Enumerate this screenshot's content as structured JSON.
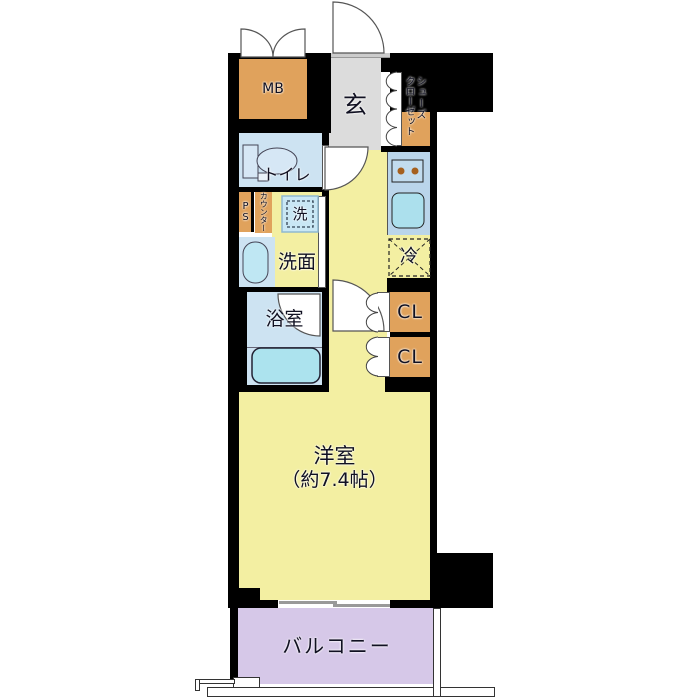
{
  "labels": {
    "mb": "MB",
    "entrance": "玄",
    "shoe_closet_line1": "シューズ",
    "shoe_closet_line2": "クローゼット",
    "toilet": "トイレ",
    "pipe_space": "PS",
    "counter": "カウンター",
    "washer": "洗",
    "washroom": "洗面",
    "fridge": "冷",
    "bathroom": "浴室",
    "closet_upper": "CL",
    "closet_lower": "CL",
    "main_room_name": "洋室",
    "main_room_size": "（約7.4帖）",
    "balcony": "バルコニー"
  },
  "colors": {
    "wall": "#000000",
    "floor_yellow": "#f3efa2",
    "entrance_gray": "#dcdcdc",
    "wet_area_blue": "#cde3f2",
    "fixture_cyan": "#aee3ef",
    "kitchen_counter_blue": "#bad5ea",
    "storage_orange": "#e0a25c",
    "balcony_purple": "#d6c8e8"
  }
}
